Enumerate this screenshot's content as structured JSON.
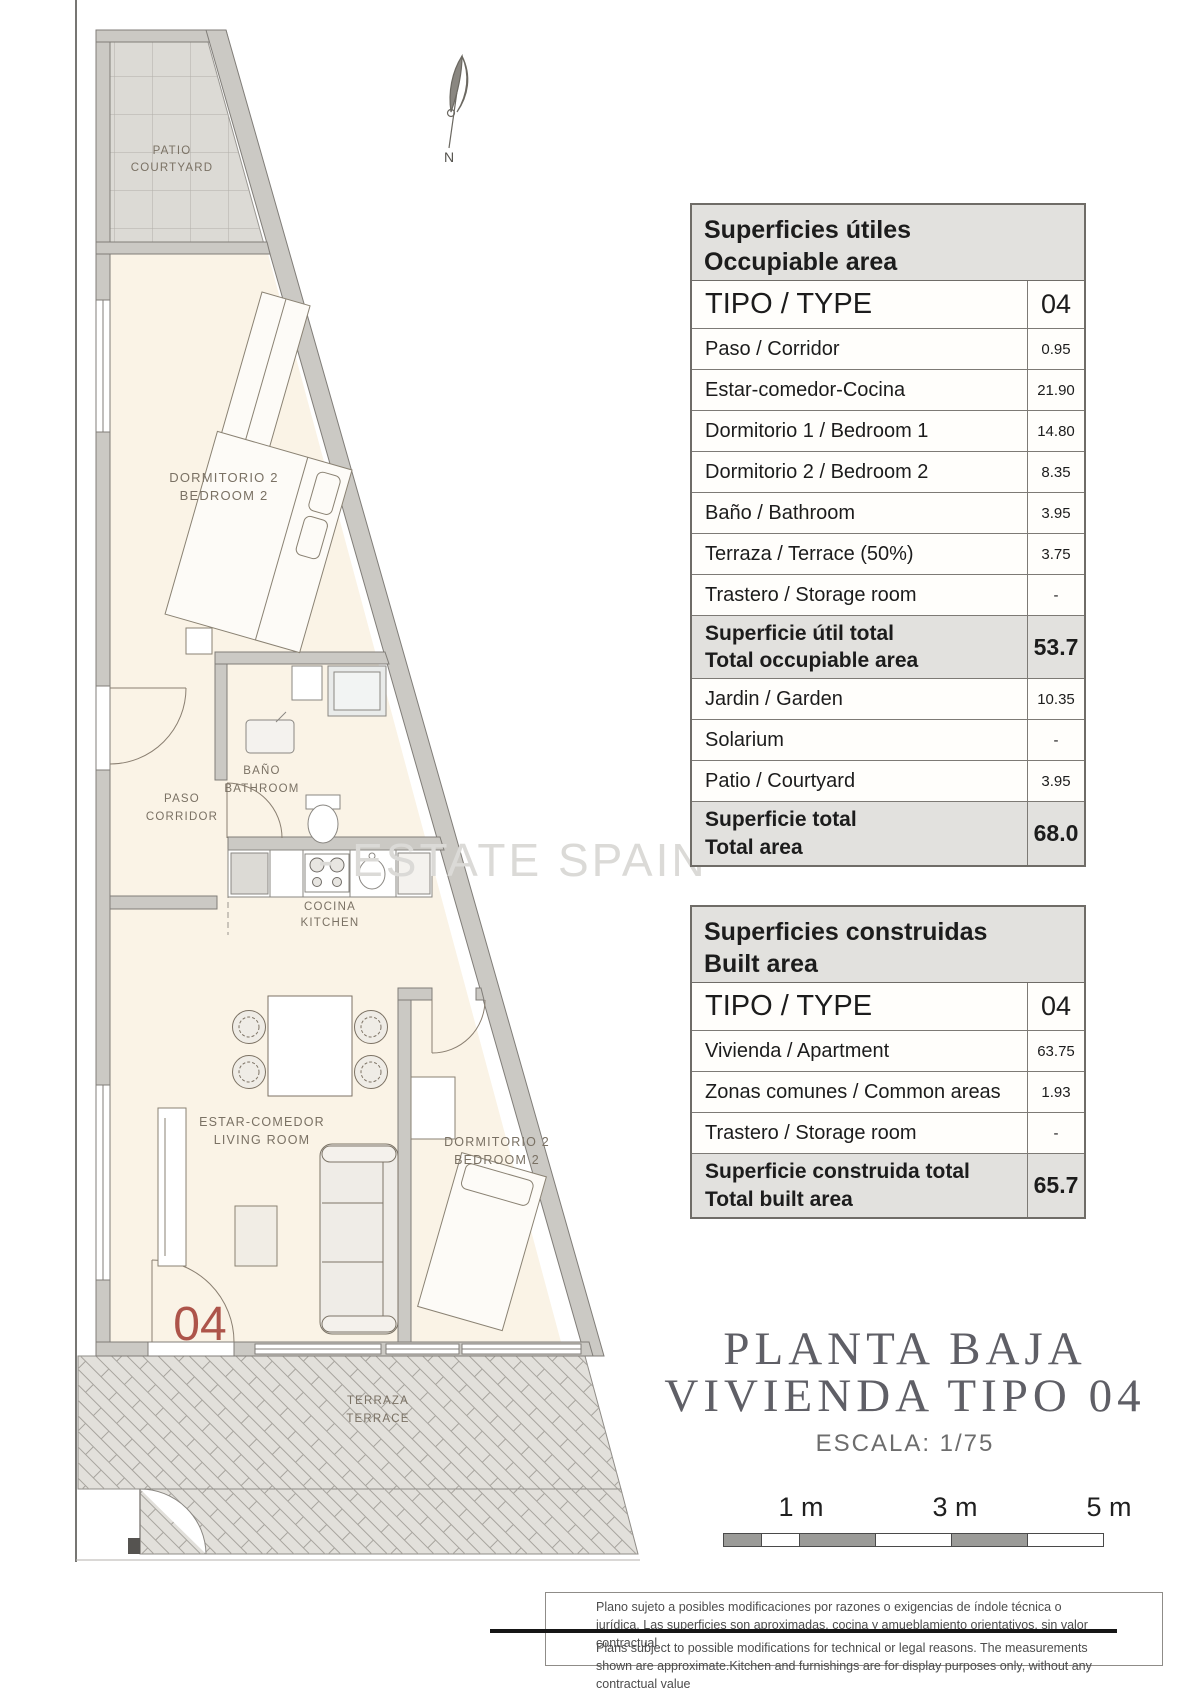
{
  "watermark": "- ESTATE SPAIN -",
  "plan": {
    "compass_n": "N",
    "unit_number": "04",
    "rooms": {
      "patio1": "PATIO",
      "patio2": "COURTYARD",
      "bed_up1": "DORMITORIO 2",
      "bed_up2": "BEDROOM 2",
      "bath1": "BAÑO",
      "bath2": "BATHROOM",
      "paso1": "PASO",
      "paso2": "CORRIDOR",
      "kitchen1": "COCINA",
      "kitchen2": "KITCHEN",
      "living1": "ESTAR-COMEDOR",
      "living2": "LIVING ROOM",
      "bed_low1": "DORMITORIO 2",
      "bed_low2": "BEDROOM 2",
      "terrace1": "TERRAZA",
      "terrace2": "TERRACE"
    }
  },
  "occupiable": {
    "header1": "Superficies útiles",
    "header2": "Occupiable area",
    "tipo_label": "TIPO / TYPE",
    "tipo_value": "04",
    "rows": [
      {
        "label": "Paso / Corridor",
        "value": "0.95"
      },
      {
        "label": "Estar-comedor-Cocina",
        "value": "21.90"
      },
      {
        "label": "Dormitorio 1 / Bedroom 1",
        "value": "14.80"
      },
      {
        "label": "Dormitorio 2 / Bedroom 2",
        "value": "8.35"
      },
      {
        "label": "Baño / Bathroom",
        "value": "3.95"
      },
      {
        "label": "Terraza / Terrace (50%)",
        "value": "3.75"
      },
      {
        "label": "Trastero / Storage room",
        "value": "-"
      }
    ],
    "subtotal": {
      "l1": "Superficie útil total",
      "l2": "Total occupiable area",
      "value": "53.7"
    },
    "rows2": [
      {
        "label": "Jardin / Garden",
        "value": "10.35"
      },
      {
        "label": "Solarium",
        "value": "-"
      },
      {
        "label": "Patio / Courtyard",
        "value": "3.95"
      }
    ],
    "total": {
      "l1": "Superficie total",
      "l2": "Total area",
      "value": "68.0"
    }
  },
  "built": {
    "header1": "Superficies construidas",
    "header2": "Built area",
    "tipo_label": "TIPO / TYPE",
    "tipo_value": "04",
    "rows": [
      {
        "label": "Vivienda / Apartment",
        "value": "63.75"
      },
      {
        "label": "Zonas comunes / Common areas",
        "value": "1.93"
      },
      {
        "label": "Trastero / Storage room",
        "value": "-"
      }
    ],
    "total": {
      "l1": "Superficie construida total",
      "l2": "Total built area",
      "value": "65.7"
    }
  },
  "title": {
    "line1": "PLANTA BAJA",
    "line2": "VIVIENDA TIPO 04",
    "scale": "ESCALA: 1/75"
  },
  "scalebar": {
    "m1": "1 m",
    "m3": "3 m",
    "m5": "5 m"
  },
  "disclaimer": {
    "es": "Plano sujeto a posibles modificaciones por razones o exigencias de índole técnica o jurídica. Las superficies son aproximadas. cocina y amueblamiento  orientativos, sin valor contractual",
    "en": "Plans subject to possible modifications for technical or legal reasons. The measurements shown are approximate.Kitchen and furnishings are for display purposes only, without any contractual value"
  }
}
